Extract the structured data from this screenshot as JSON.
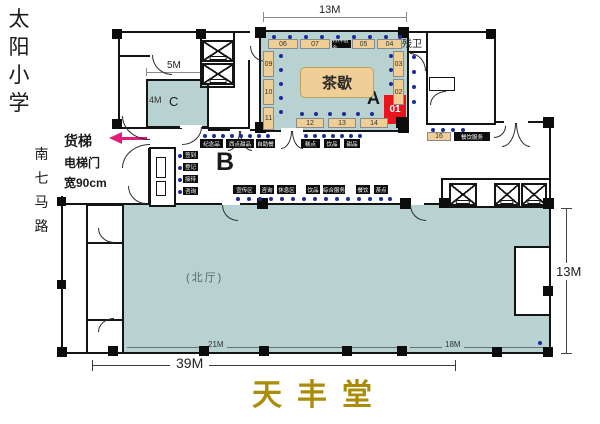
{
  "left_panel": {
    "school": "太阳小学",
    "road": "南七马路",
    "freight": "货梯",
    "door": "电梯门",
    "door_width": "宽90cm"
  },
  "zones": {
    "a": "A",
    "b": "B",
    "c": "C"
  },
  "rooms": {
    "tea": "茶歇",
    "hall": "(北厅)",
    "men": "男卫生间",
    "women": "女卫生间",
    "accessible": "残卫",
    "makeup": "化妆间",
    "stage_left": "舞台",
    "stage_right": "舞台",
    "audio": "音箱室"
  },
  "dims": {
    "top_width": "13M",
    "c_width": "5M",
    "c_height": "4M",
    "right_height": "13M",
    "hall_left": "21M",
    "hall_right": "18M",
    "total_width": "39M"
  },
  "booths": {
    "red": "01",
    "top": [
      "06",
      "07",
      "05",
      "04"
    ],
    "left": [
      "09",
      "10",
      "11"
    ],
    "right": [
      "03",
      "02"
    ],
    "bottom": [
      "12",
      "13",
      "14"
    ],
    "strip": "16"
  },
  "services": {
    "tea_top_black": "特种租金",
    "below_left": [
      "纪念品",
      "西点甜品",
      "自助餐"
    ],
    "below_right": [
      "糕点",
      "饮品",
      "甜品"
    ],
    "strip_black": "餐饮服务",
    "desk": [
      "签到",
      "登记",
      "接待",
      "咨询"
    ],
    "hall_row": [
      "宣传区",
      "咨询",
      "休息区",
      "饮品",
      "综合服务",
      "餐饮",
      "茶点"
    ]
  },
  "title": "天丰堂"
}
